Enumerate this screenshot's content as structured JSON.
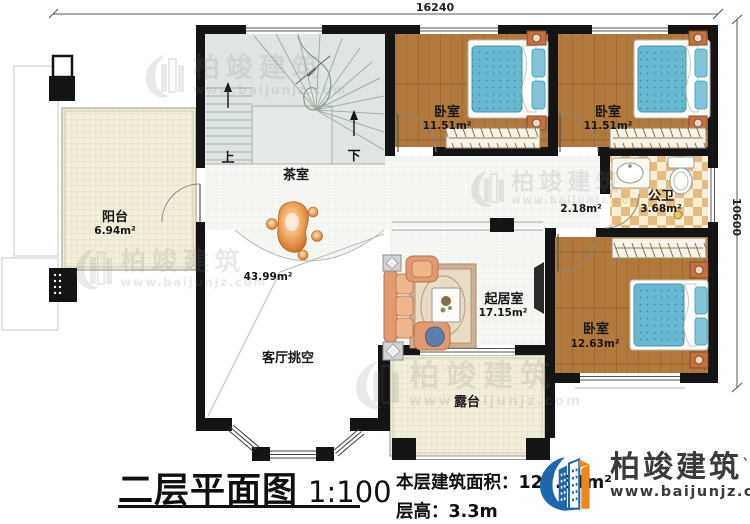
{
  "header": {
    "dim_top": "16240",
    "dim_right": "10600"
  },
  "rooms": {
    "balcony": {
      "name": "阳台",
      "area": "6.94m²"
    },
    "tea_room": {
      "name": "茶室"
    },
    "bedroom1": {
      "name": "卧室",
      "area": "11.51m²"
    },
    "bedroom2": {
      "name": "卧室",
      "area": "11.51m²"
    },
    "corridor": {
      "area": "2.18m²"
    },
    "bathroom": {
      "name": "公卫",
      "area": "3.68m²"
    },
    "living": {
      "name": "起居室",
      "area": "17.15m²"
    },
    "bedroom3": {
      "name": "卧室",
      "area": "12.63m²"
    },
    "void": {
      "name": "客厅挑空",
      "area": "43.99m²"
    },
    "terrace": {
      "name": "露台"
    }
  },
  "stairs": {
    "up": "上",
    "down": "下"
  },
  "titleblock": {
    "title": "二层平面图",
    "scale": "1:100",
    "area_label": "本层建筑面积：",
    "area_value": "127.51m²",
    "height_label": "层高：",
    "height_value": "3.3m"
  },
  "brand": {
    "company": "柏竣建筑",
    "website": "www.baijunjz.com",
    "mark": "`",
    "accent_blue": "#1c67ad",
    "accent_orange": "#f08519"
  },
  "watermark": {
    "company": "柏竣建筑",
    "website": "www.baijunjz.com"
  }
}
